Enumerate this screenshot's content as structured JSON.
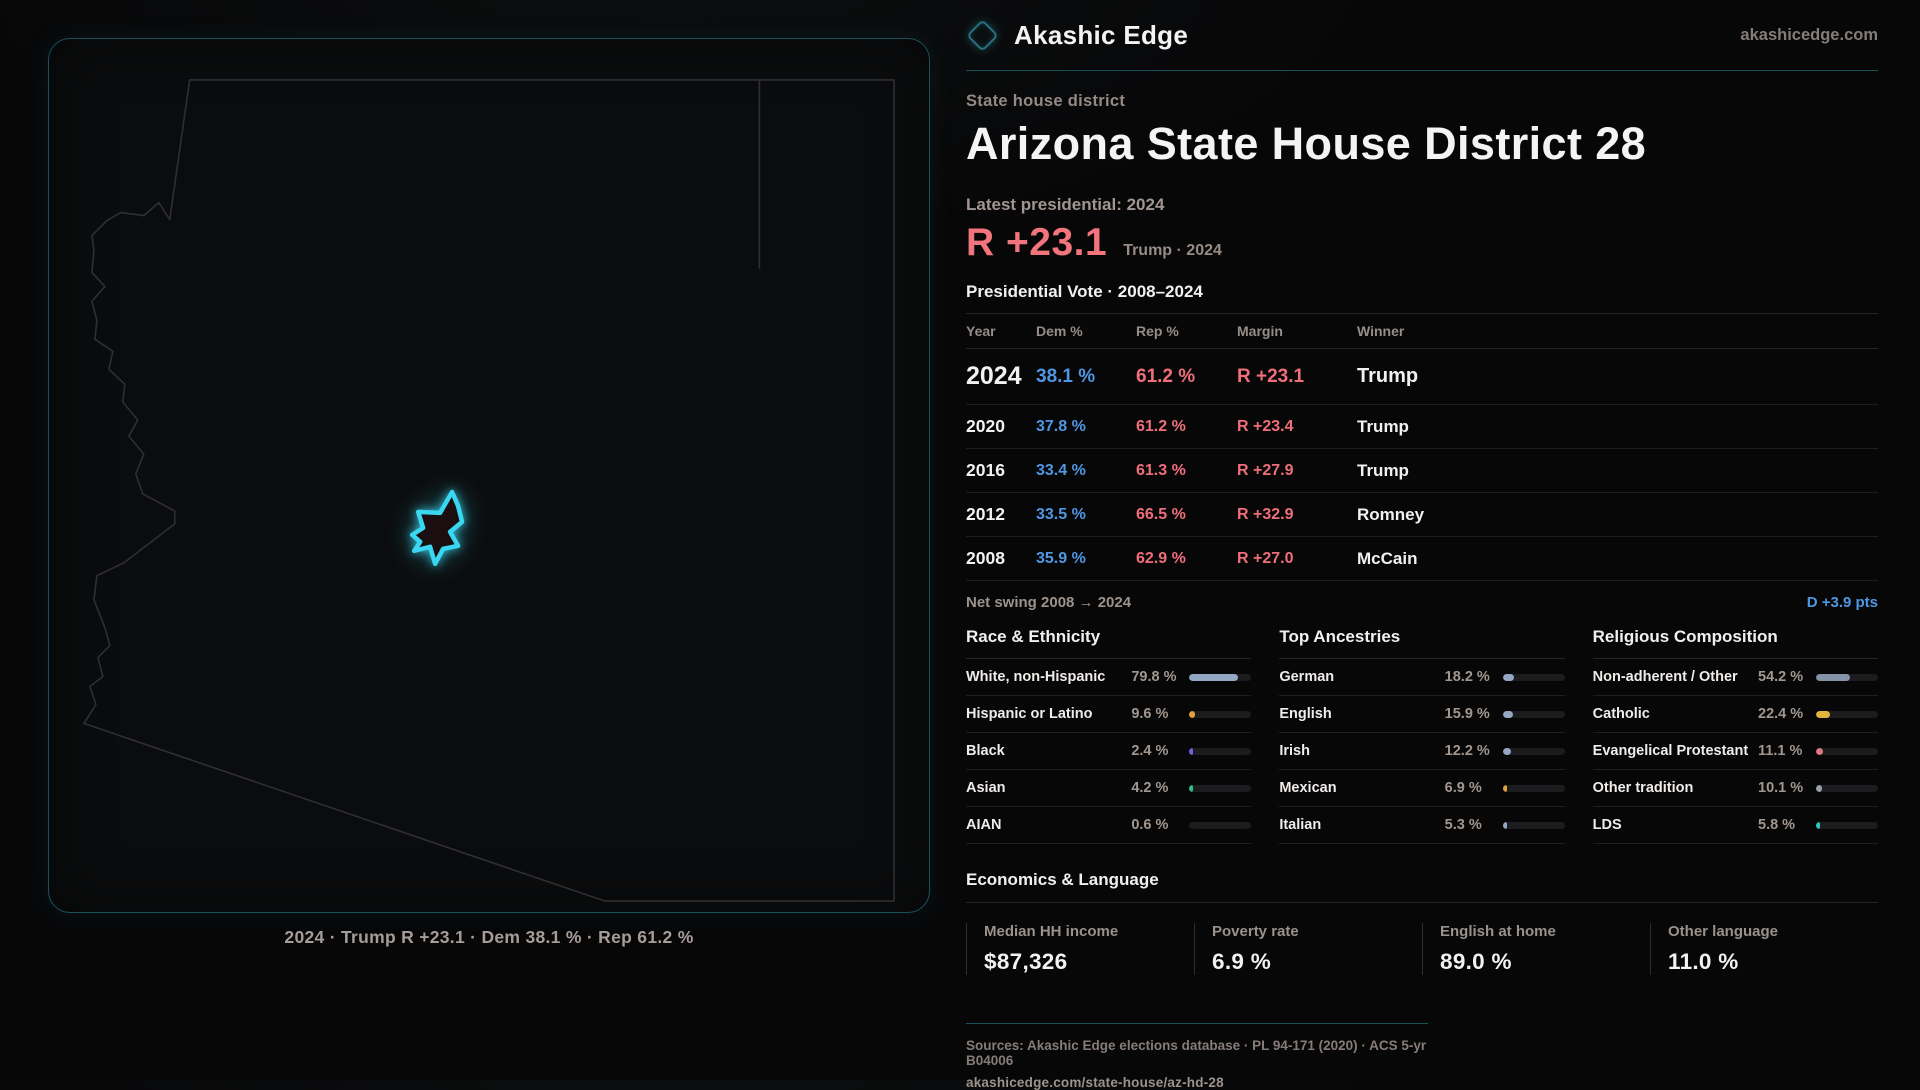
{
  "colors": {
    "teal-line": "#1b515c",
    "accent-cyan": "#3ad7f0",
    "dem-blue": "#4f97e3",
    "rep-red": "#ee6f79",
    "margin-red": "#f2747d",
    "text-white": "#f4f2f0",
    "bar-track": "#1c1c1e"
  },
  "brand": {
    "name": "Akashic Edge",
    "domain": "akashicedge.com",
    "logo": "diamond-icon"
  },
  "map": {
    "caption": "2024 · Trump R +23.1 · Dem 38.1 % · Rep 61.2 %"
  },
  "header": {
    "kicker": "State house district",
    "title": "Arizona State House District 28",
    "latest_label": "Latest presidential: 2024",
    "margin_big": "R +23.1",
    "margin_note": "Trump · 2024"
  },
  "table": {
    "title": "Presidential Vote · 2008–2024",
    "columns": [
      "Year",
      "Dem %",
      "Rep %",
      "Margin",
      "Winner"
    ],
    "rows": [
      {
        "year": "2024",
        "dem": "38.1 %",
        "rep": "61.2 %",
        "margin": "R +23.1",
        "winner": "Trump"
      },
      {
        "year": "2020",
        "dem": "37.8 %",
        "rep": "61.2 %",
        "margin": "R +23.4",
        "winner": "Trump"
      },
      {
        "year": "2016",
        "dem": "33.4 %",
        "rep": "61.3 %",
        "margin": "R +27.9",
        "winner": "Trump"
      },
      {
        "year": "2012",
        "dem": "33.5 %",
        "rep": "66.5 %",
        "margin": "R +32.9",
        "winner": "Romney"
      },
      {
        "year": "2008",
        "dem": "35.9 %",
        "rep": "62.9 %",
        "margin": "R +27.0",
        "winner": "McCain"
      }
    ]
  },
  "net_swing": {
    "label": "Net swing 2008 → 2024",
    "value": "D +3.9 pts"
  },
  "demographics": [
    {
      "title": "Race & Ethnicity",
      "rows": [
        {
          "label": "White, non-Hispanic",
          "value": "79.8 %",
          "pct": 79.8,
          "color": "#93a7c4"
        },
        {
          "label": "Hispanic or Latino",
          "value": "9.6 %",
          "pct": 9.6,
          "color": "#e2a23b"
        },
        {
          "label": "Black",
          "value": "2.4 %",
          "pct": 2.4,
          "color": "#7b5ce0"
        },
        {
          "label": "Asian",
          "value": "4.2 %",
          "pct": 4.2,
          "color": "#2fbf85"
        },
        {
          "label": "AIAN",
          "value": "0.6 %",
          "pct": 0.6,
          "color": "#9aa0a8"
        }
      ]
    },
    {
      "title": "Top Ancestries",
      "rows": [
        {
          "label": "German",
          "value": "18.2 %",
          "pct": 18.2,
          "color": "#93a7c4"
        },
        {
          "label": "English",
          "value": "15.9 %",
          "pct": 15.9,
          "color": "#93a7c4"
        },
        {
          "label": "Irish",
          "value": "12.2 %",
          "pct": 12.2,
          "color": "#93a7c4"
        },
        {
          "label": "Mexican",
          "value": "6.9 %",
          "pct": 6.9,
          "color": "#e2a23b"
        },
        {
          "label": "Italian",
          "value": "5.3 %",
          "pct": 5.3,
          "color": "#93a7c4"
        }
      ]
    },
    {
      "title": "Religious Composition",
      "rows": [
        {
          "label": "Non-adherent / Other",
          "value": "54.2 %",
          "pct": 54.2,
          "color": "#8593a9"
        },
        {
          "label": "Catholic",
          "value": "22.4 %",
          "pct": 22.4,
          "color": "#e0b33c"
        },
        {
          "label": "Evangelical Protestant",
          "value": "11.1 %",
          "pct": 11.1,
          "color": "#e0787f"
        },
        {
          "label": "Other tradition",
          "value": "10.1 %",
          "pct": 10.1,
          "color": "#9aa0a8"
        },
        {
          "label": "LDS",
          "value": "5.8 %",
          "pct": 5.8,
          "color": "#2cc9b8"
        }
      ]
    }
  ],
  "economics": {
    "title": "Economics & Language",
    "stats": [
      {
        "label": "Median HH income",
        "value": "$87,326"
      },
      {
        "label": "Poverty rate",
        "value": "6.9 %"
      },
      {
        "label": "English at home",
        "value": "89.0 %"
      },
      {
        "label": "Other language",
        "value": "11.0 %"
      }
    ]
  },
  "footer": {
    "sources": "Sources: Akashic Edge elections database · PL 94-171 (2020) · ACS 5-yr B04006",
    "permalink": "akashicedge.com/state-house/az-hd-28"
  }
}
